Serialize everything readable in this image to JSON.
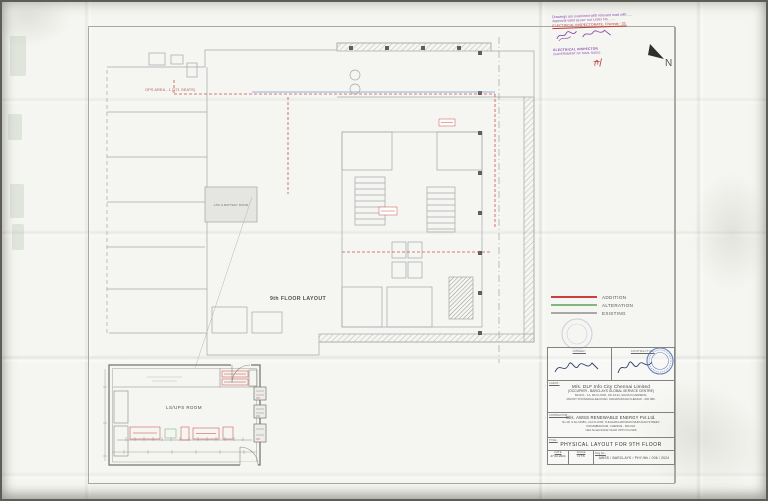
{
  "north": {
    "label": "N"
  },
  "stamp": {
    "lines": [
      "Drawings are examined with relevant read with .....",
      "Approval valid as per our Letter No. .....",
      "ELECTRICAL INSPECTORATE, Chennai - 32.",
      "ELECTRICAL INSPECTOR",
      "(GOVERNMENT OF TAMIL NADU)"
    ]
  },
  "plan": {
    "floor_label": "9th FLOOR LAYOUT",
    "ops_label": "OPS AREA - 1 (271 SEATS)",
    "ahu_label": "AHU & BATTERY ROOM",
    "ups_room_label": "LS/UPS ROOM"
  },
  "legend": {
    "items": [
      {
        "label": "ADDITION",
        "color": "#c94040"
      },
      {
        "label": "ALTERATION",
        "color": "#7fb77f"
      },
      {
        "label": "EXISTING",
        "color": "#a8a8a4"
      }
    ]
  },
  "title_block": {
    "owner_header": "OWNER:",
    "contractor_header": "CONTRACTOR:",
    "client_label": "CLIENT:-",
    "client_name": "M/s. DLF Info City Chennai Limited",
    "client_line2": "(OCCUPIER - BARCLAYS GLOBAL SERVICE CENTRE)",
    "client_line3": "BLOCK - 1A, 9th FLOOR, NO.1/124, SHIVAJI GARDENS,",
    "client_line4": "MOUNT POONAMALLEE ROAD, MANAPAKKAM CHENNAI - 600 089.",
    "contractor_label": "CONTRACTOR:-",
    "contractor_name": "M/s. AWSS RENEWABLE ENERGY Pvt.Ltd.",
    "contractor_line2": "No.18, S.No.1638/1, 2nd FLOOR, THIAGARAJAPURAM MURUGAN STREET,",
    "contractor_line3": "KODAMBAKKAM, CHENNAI - 600 024.",
    "contractor_line4": "CEA No.EA/13442 VALID UPTO 04.2026",
    "title_label": "TITLE:-",
    "drawing_title": "PHYSICAL LAYOUT FOR 9TH FLOOR",
    "date_label": "DATE",
    "date_value": "27.02.2024",
    "scale_label": "SCALE",
    "scale_value": "N.T.S",
    "dwg_label": "Dwg.No:-",
    "dwg_value": "AWSS / BARCLAYS / PHY-9th / 006 / 2024"
  }
}
